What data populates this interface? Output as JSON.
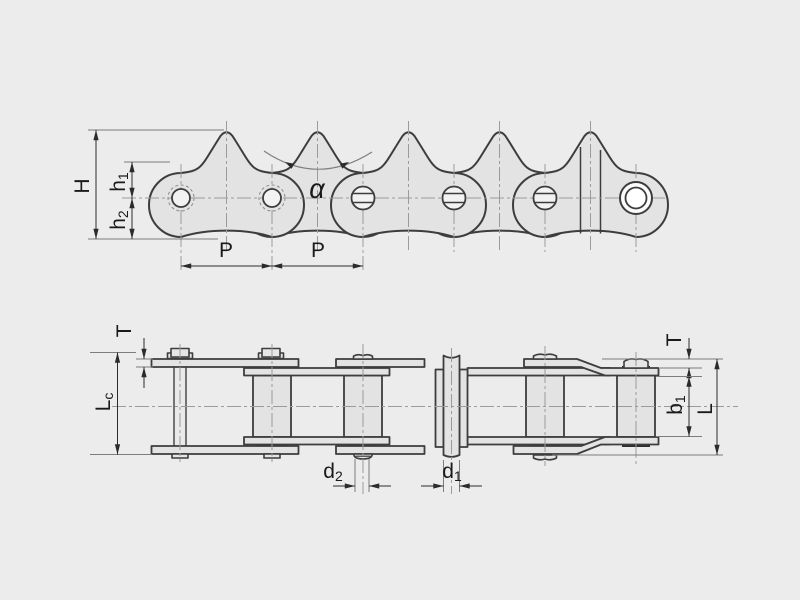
{
  "colors": {
    "background": "#ececec",
    "plate_fill": "#e3e3e3",
    "outline": "#3d3d3d",
    "centerline": "#9b9b9b",
    "dark_ring": "#2e2e2e",
    "dimension_line": "#2b2b2b"
  },
  "side_view": {
    "labels": {
      "overall_height": "H",
      "plate_height_upper": {
        "main": "h",
        "sub": "1"
      },
      "plate_height_lower": {
        "main": "h",
        "sub": "2"
      },
      "pitch_1": "P",
      "pitch_2": "P",
      "tooth_angle": "α"
    }
  },
  "plan_view": {
    "labels": {
      "plate_thickness_left": "T",
      "pin_length_over_cotter": {
        "main": "L",
        "sub": "c"
      },
      "pin_diameter": {
        "main": "d",
        "sub": "2"
      },
      "bush_diameter": {
        "main": "d",
        "sub": "1"
      },
      "plate_thickness_right": "T",
      "inner_width": {
        "main": "b",
        "sub": "1"
      },
      "pin_length": "L"
    }
  }
}
